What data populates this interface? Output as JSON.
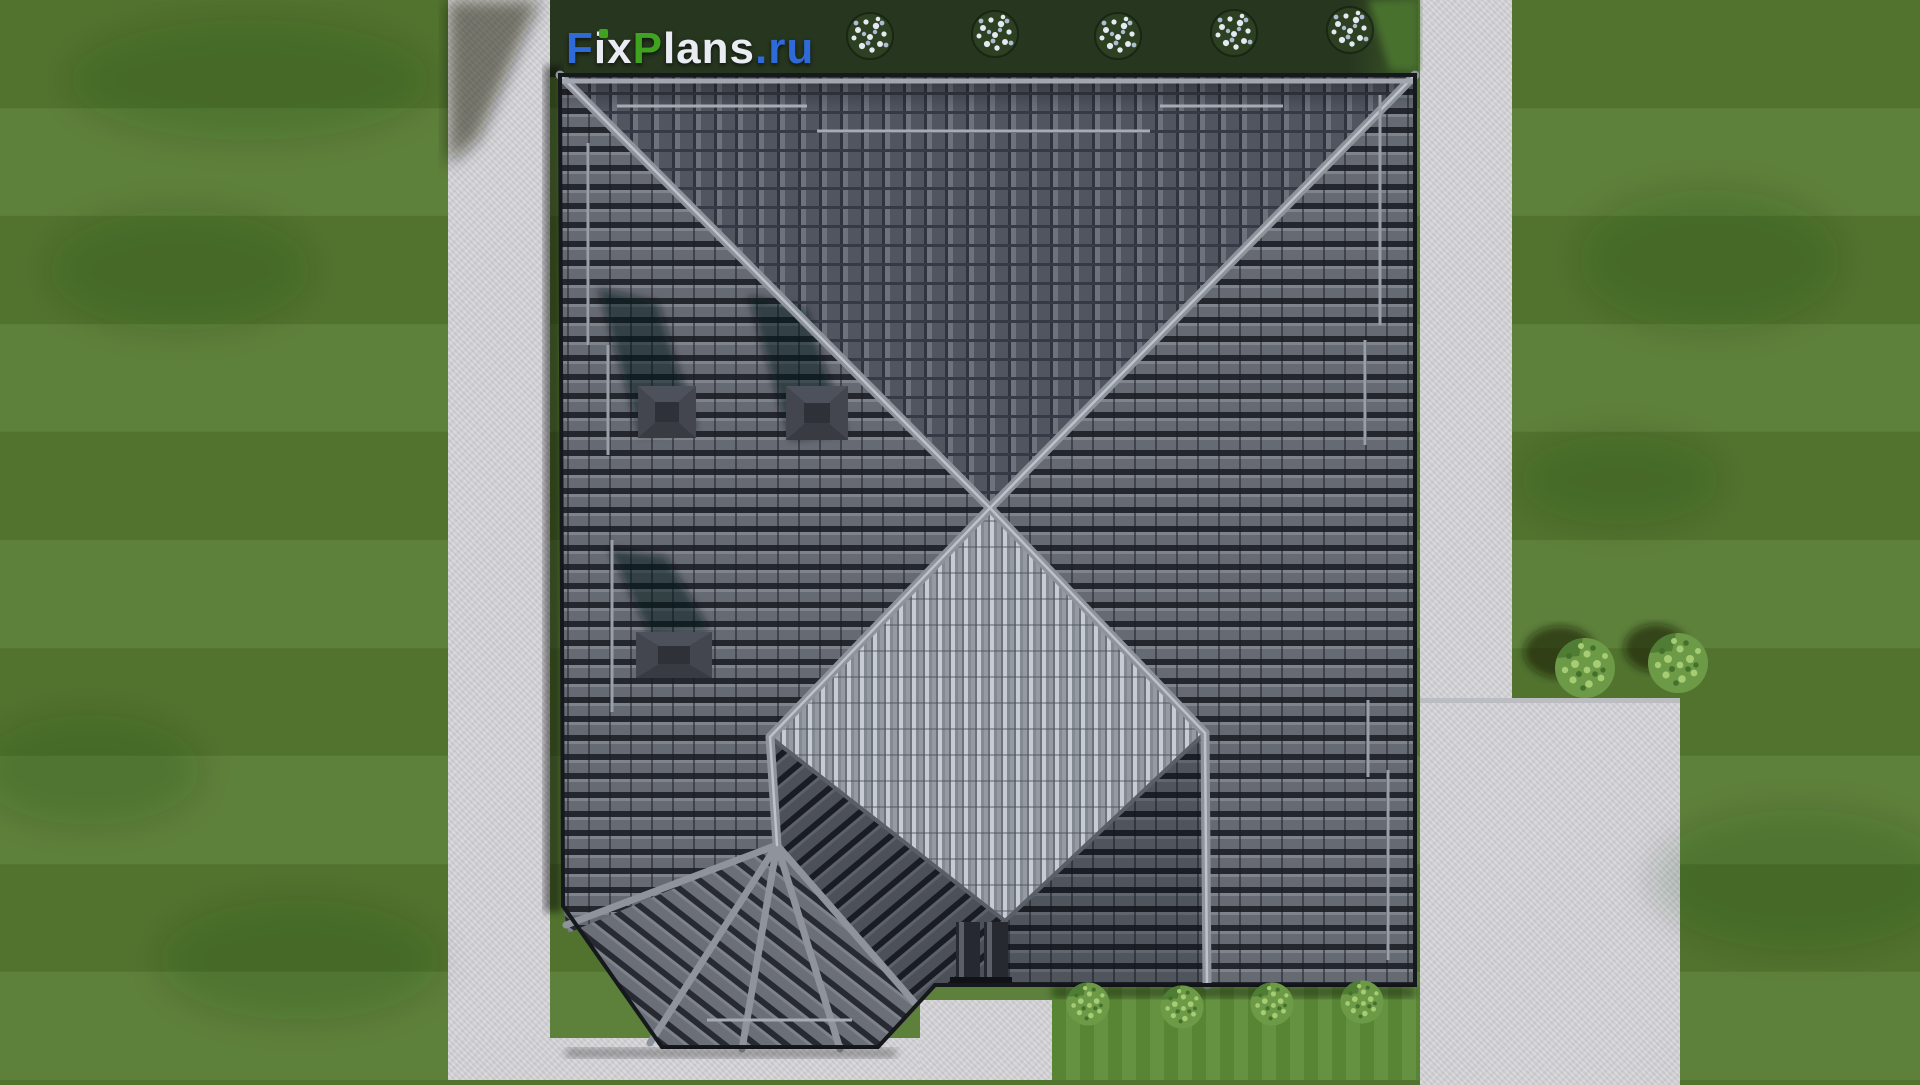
{
  "watermark": {
    "segments": [
      {
        "text": "F",
        "color": "blue"
      },
      {
        "text": "ix",
        "color": "white"
      },
      {
        "text": "P",
        "color": "green"
      },
      {
        "text": "lans",
        "color": "white"
      },
      {
        "text": ".ru",
        "color": "blue"
      }
    ]
  },
  "palette": {
    "lawn_base": "#567a31",
    "grass_bright": "#5d8c36",
    "hedge_dark": "#27361f",
    "concrete": "#d7d7db",
    "concrete_edge": "#bcbcc3",
    "roof_row_base": "#666a73",
    "roof_row_dark": "#24272e",
    "roof_north": "#51555f",
    "roof_diamond": "#979ca5",
    "ridge_gray": "#8f949c",
    "ridge_highlight": "#c3c8d0",
    "chimney_gray": "#43464e",
    "flower_white": "#e4e9f2",
    "bush_green": "#6c9a47",
    "logo_blue": "#2f6ad9",
    "logo_green": "#3fa31f",
    "logo_white": "#e9ecf3"
  }
}
